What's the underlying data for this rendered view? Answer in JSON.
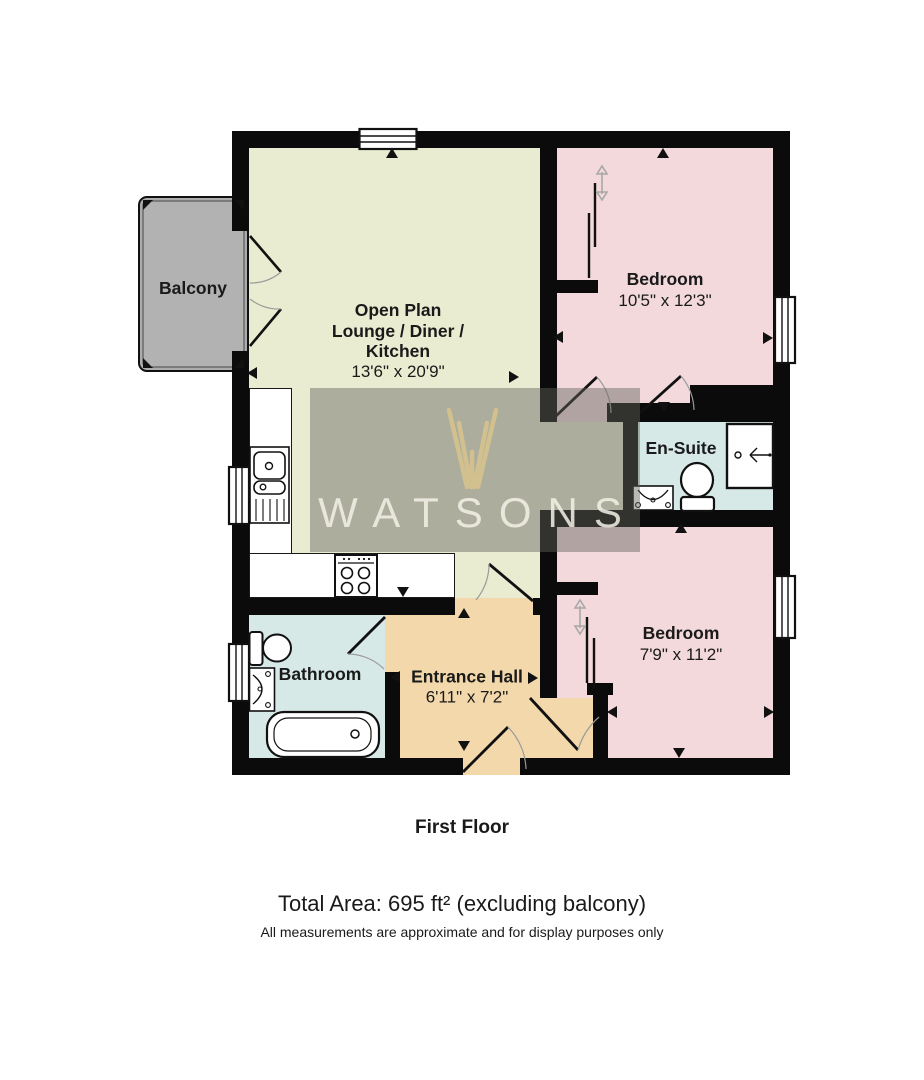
{
  "floorplan": {
    "watermark": {
      "brand": "WATSONS"
    },
    "footer": {
      "floor_label": "First Floor",
      "total_area": "Total Area: 695 ft² (excluding balcony)",
      "disclaimer": "All measurements are approximate and for display purposes only"
    },
    "rooms": {
      "balcony": {
        "name": "Balcony"
      },
      "lounge": {
        "line1": "Open Plan",
        "line2": "Lounge / Diner /",
        "line3": "Kitchen",
        "dims": "13'6\" x 20'9\""
      },
      "bedroom1": {
        "name": "Bedroom",
        "dims": "10'5\" x 12'3\""
      },
      "ensuite": {
        "name": "En-Suite"
      },
      "bedroom2": {
        "name": "Bedroom",
        "dims": "7'9\" x 11'2\""
      },
      "bathroom": {
        "name": "Bathroom"
      },
      "entrance_hall": {
        "name": "Entrance Hall",
        "dims": "6'11\" x 7'2\""
      }
    },
    "colors": {
      "wall": "#0b0b0b",
      "lounge": "#eaecd1",
      "bedroom": "#f3d9db",
      "wet_room": "#d6e9e6",
      "hall": "#f2d8ab",
      "balcony": "#b2b2b2",
      "watermark_box": "rgba(98,98,90,0.45)",
      "watermark_text": "#f4f2e7",
      "watermark_logo": "#d9c58d"
    }
  }
}
